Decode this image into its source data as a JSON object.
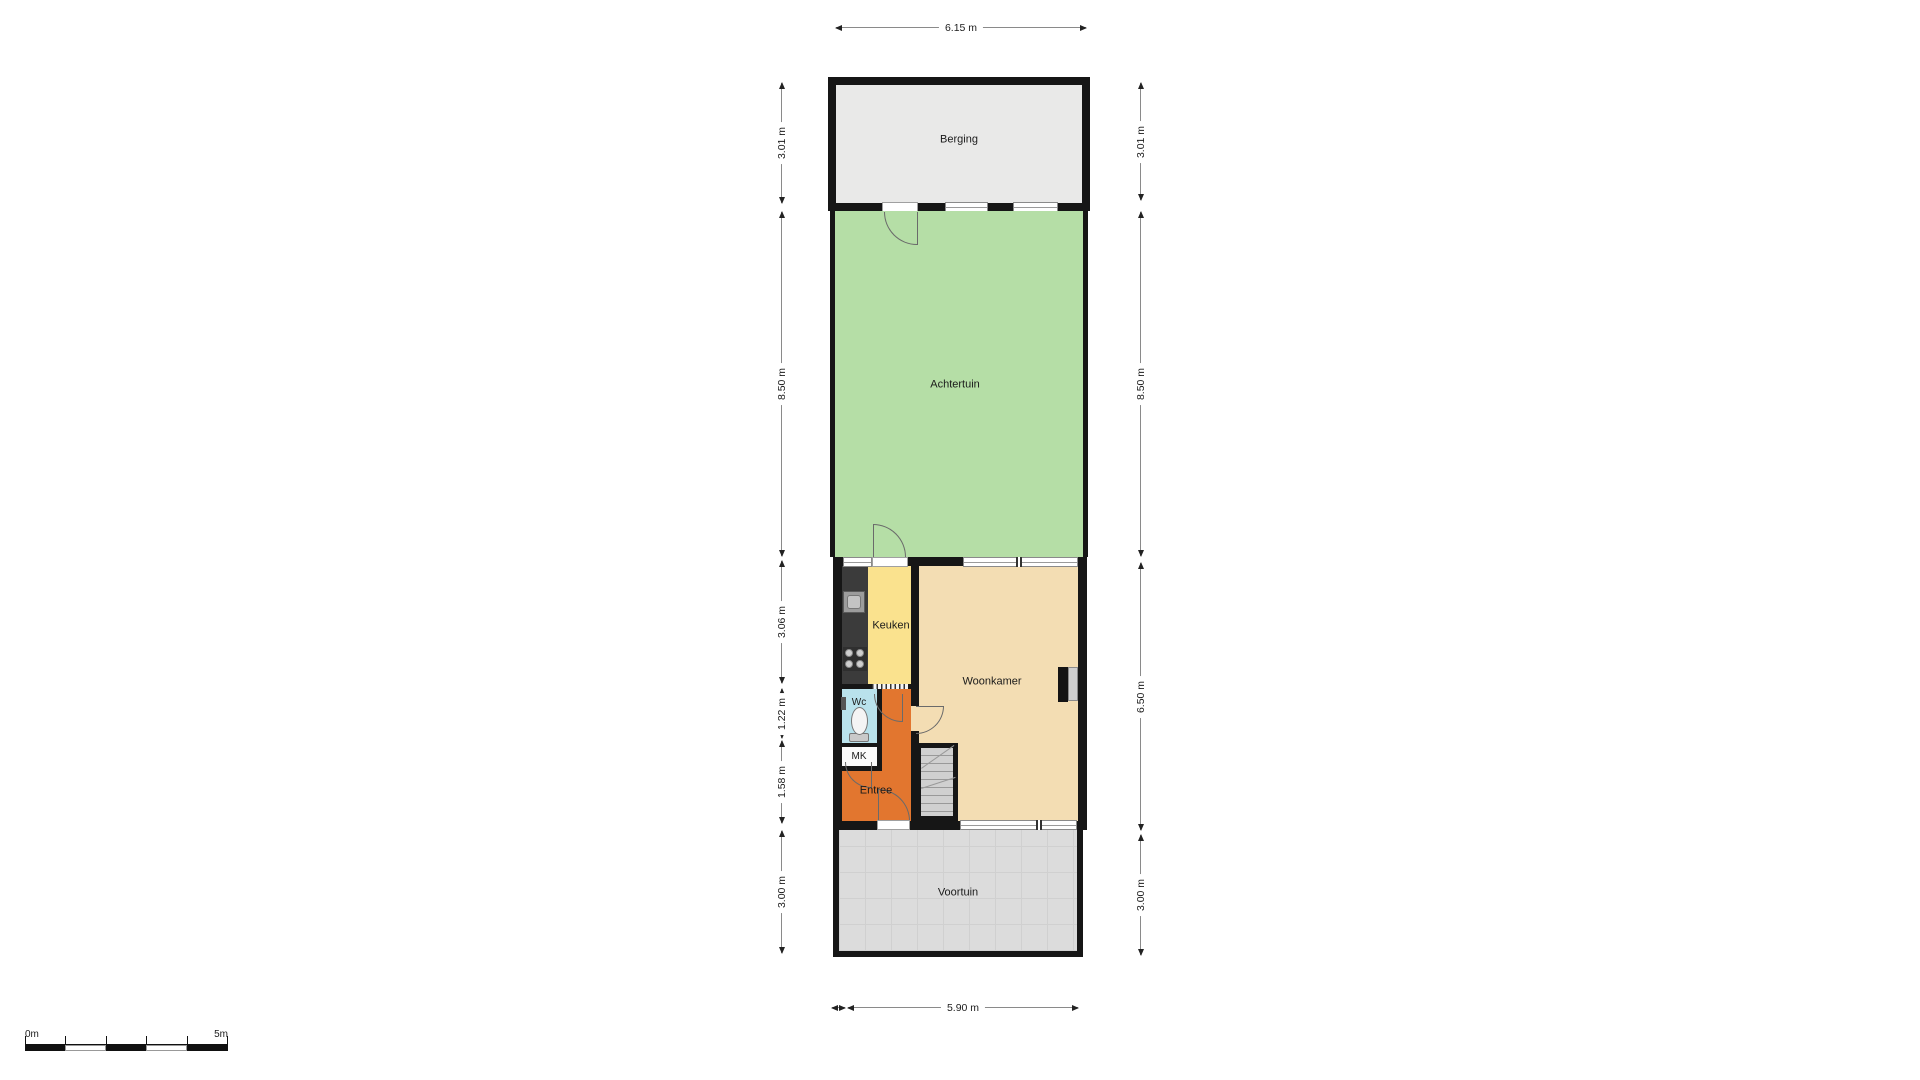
{
  "plan": {
    "rooms": {
      "berging": "Berging",
      "achtertuin": "Achtertuin",
      "keuken": "Keuken",
      "woonkamer": "Woonkamer",
      "wc": "Wc",
      "mk": "MK",
      "entree": "Entree",
      "voortuin": "Voortuin"
    },
    "dimensions": {
      "top": "6.15 m",
      "bottom": "5.90 m",
      "left": [
        "3.01 m",
        "8.50 m",
        "3.06 m",
        "1.22 m",
        "1.58 m",
        "3.00 m"
      ],
      "right": [
        "3.01 m",
        "8.50 m",
        "6.50 m",
        "3.00 m"
      ]
    },
    "scale_bar": {
      "start": "0m",
      "end": "5m"
    },
    "colors": {
      "wall": "#161616",
      "berging_fill": "#e9e9e8",
      "achtertuin_fill": "#b5dea6",
      "keuken_fill": "#fae28e",
      "woonkamer_fill": "#f3ddb3",
      "entree_fill": "#e2762f",
      "wc_fill": "#b9e2ec",
      "mk_fill": "#fafafa",
      "voortuin_fill": "#dcdcdc",
      "counter_fill": "#3b3b3b",
      "stairs_fill": "#d0d0d0"
    }
  }
}
